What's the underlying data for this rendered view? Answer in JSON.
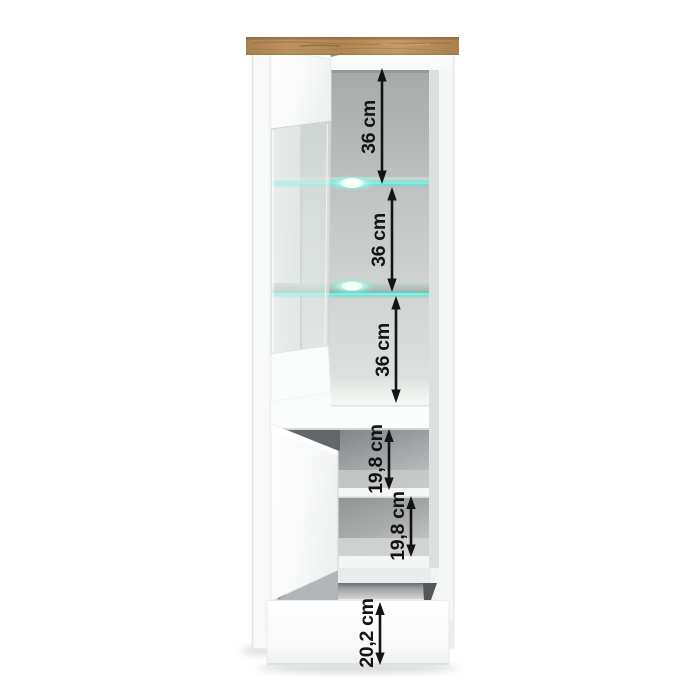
{
  "image": {
    "type": "product-dimension-illustration",
    "subject": "tall display cabinet with open glass door, LED glass shelves, open lower door and open bottom drawer"
  },
  "colors": {
    "background": "#ffffff",
    "cabinet_white": "#f8f9f9",
    "oak_top": "#b58b55",
    "led_cyan": "#4fe0d4",
    "led_glow": "#aaf4ec",
    "interior_gray": "#aeb3b1",
    "lower_interior_gray": "#8e9193",
    "dimension_black": "#141414"
  },
  "dimensions": [
    {
      "id": "upper-shelf-gap-1",
      "label": "36 cm"
    },
    {
      "id": "upper-shelf-gap-2",
      "label": "36 cm"
    },
    {
      "id": "upper-shelf-gap-3",
      "label": "36 cm"
    },
    {
      "id": "lower-compartment-1",
      "label": "19,8 cm"
    },
    {
      "id": "lower-compartment-2",
      "label": "19,8 cm"
    },
    {
      "id": "drawer-height",
      "label": "20,2 cm"
    }
  ]
}
